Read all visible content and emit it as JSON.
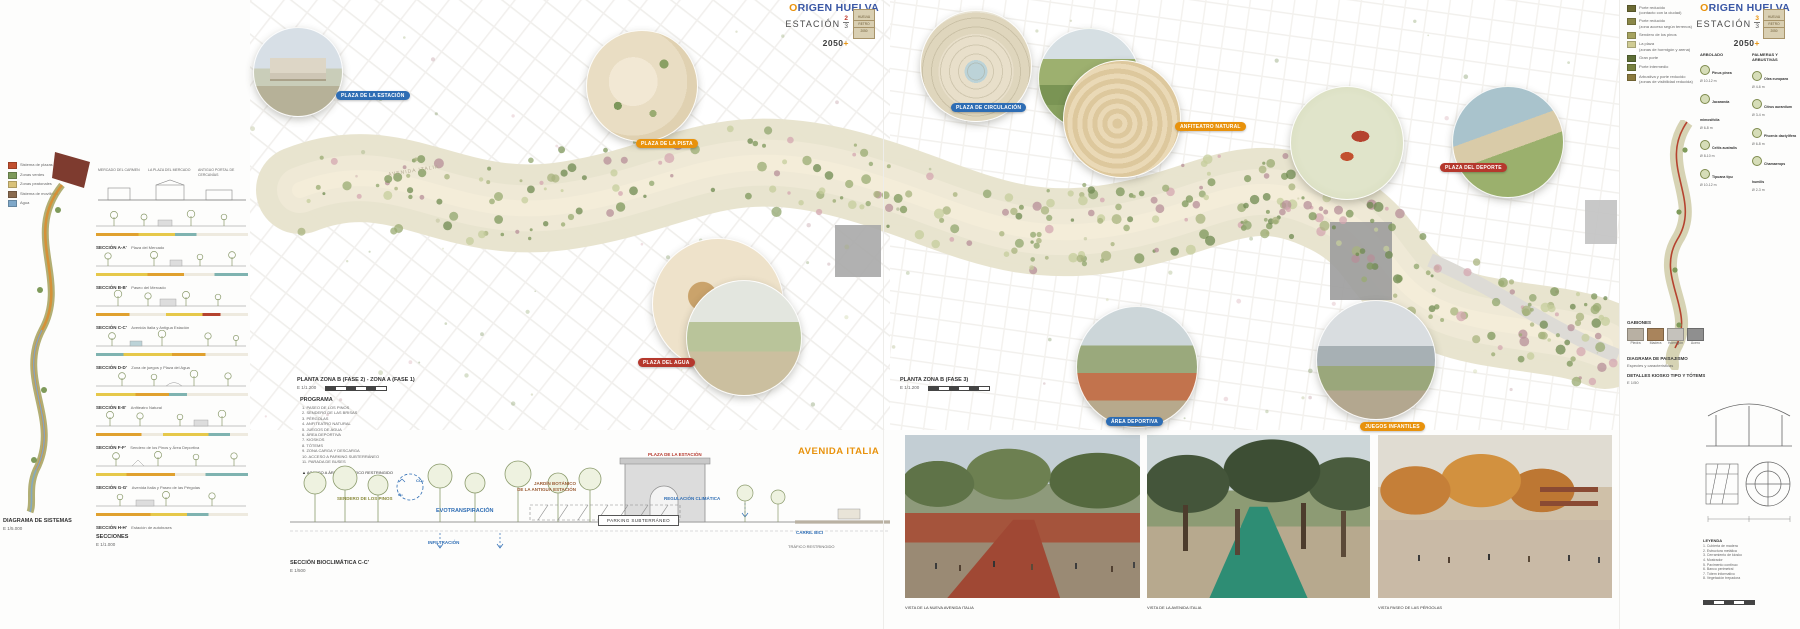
{
  "headers": {
    "left": {
      "brand_o": "O",
      "brand_rest": "RIGEN",
      "brand_b": "HUELVA",
      "station": "ESTACIÓN",
      "sheet_num": "2",
      "sheet_total": "3",
      "year": "2050",
      "year_plus": "+",
      "stamp_lines": [
        "HUELVA",
        "RETRO",
        "2050"
      ]
    },
    "right": {
      "brand_o": "O",
      "brand_rest": "RIGEN",
      "brand_b": "HUELVA",
      "station": "ESTACIÓN",
      "sheet_num": "3",
      "sheet_total": "3",
      "year": "2050",
      "year_plus": "+",
      "stamp_lines": [
        "HUELVA",
        "RETRO",
        "2050"
      ]
    }
  },
  "colors": {
    "badge_blue": "#2e6db4",
    "badge_orange": "#e8920c",
    "badge_red": "#b5382d",
    "brand_blue": "#3a57a5",
    "accent_orange": "#e8920c"
  },
  "plan": {
    "street_label": "AVENIDA ITALIA",
    "badges": [
      {
        "label": "PLAZA DE LA ESTACIÓN",
        "color": "blue"
      },
      {
        "label": "PLAZA DE LA PISTA",
        "color": "orange"
      },
      {
        "label": "PLAZA DE CIRCULACIÓN",
        "color": "blue"
      },
      {
        "label": "ANFITEATRO NATURAL",
        "color": "orange"
      },
      {
        "label": "PLAZA DEL DEPORTE",
        "color": "red"
      },
      {
        "label": "PLAZA DEL AGUA",
        "color": "red"
      },
      {
        "label": "ÁREA DEPORTIVA",
        "color": "blue"
      },
      {
        "label": "JUEGOS INFANTILES",
        "color": "orange"
      }
    ]
  },
  "systems": {
    "legend": [
      {
        "label": "Sistema de plazas",
        "color": "#c2502f"
      },
      {
        "label": "Zonas verdes",
        "color": "#7e9a5a"
      },
      {
        "label": "Zonas peatonales",
        "color": "#d9c27a"
      },
      {
        "label": "Sistema de movilidad",
        "color": "#8a6b4f"
      },
      {
        "label": "Agua",
        "color": "#7fa8c9"
      }
    ],
    "caption": "DIAGRAMA DE SISTEMAS",
    "scale": "E 1/5.000"
  },
  "sections": {
    "top_labels": [
      "MERCADO DEL CARMEN",
      "LA PLAZA DEL MERCADO",
      "ANTIGUO PORTAL DE CERCANÍAS"
    ],
    "items": [
      {
        "id": "SECCIÓN A-A'",
        "caption": "Plaza del Mercado"
      },
      {
        "id": "SECCIÓN B-B'",
        "caption": "Paseo del Mercado"
      },
      {
        "id": "SECCIÓN C-C'",
        "caption": "Avenida Italia y Antigua Estación"
      },
      {
        "id": "SECCIÓN D-D'",
        "caption": "Zona de juegos y Plaza del Agua"
      },
      {
        "id": "SECCIÓN E-E'",
        "caption": "Anfiteatro Natural"
      },
      {
        "id": "SECCIÓN F-F'",
        "caption": "Sendero de los Pinos y Área Deportiva"
      },
      {
        "id": "SECCIÓN G-G'",
        "caption": "Avenida Italia y Paseo de las Pérgolas"
      },
      {
        "id": "SECCIÓN H-H'",
        "caption": "Estación de autobuses"
      }
    ],
    "footer": "SECCIONES",
    "footer_scale": "E 1/1.000"
  },
  "bottom_left": {
    "plan_title": "PLANTA ZONA B (FASE 2) - ZONA A (FASE 1)",
    "plan_scale": "E 1/1.200",
    "programa_title": "PROGRAMA",
    "programa": [
      "1. PASEO DE LOS PINOS",
      "2. SENDERO DE LAS BRISAS",
      "3. PÉRGOLAS",
      "4. ANFITEATRO NATURAL",
      "5. JUEGOS DE AGUA",
      "6. ÁREA DEPORTIVA",
      "7. KIOSKOS",
      "8. TÓTEMS",
      "9. ZONA CARGA Y DESCARGA",
      "10. ACCESO A PARKING SUBTERRÁNEO",
      "11. PARADA DE BUSES"
    ],
    "nota": "▲  ACCESO A ÁREA DE TRÁFICO RESTRINGIDO",
    "labels": {
      "sendero": "SENDERO DE LOS PINOS",
      "evo": "EVOTRANSPIRACIÓN",
      "jardin_1": "JARDÍN BOTÁNICO",
      "jardin_2": "DE LA ANTIGUA ESTACIÓN",
      "plaza": "PLAZA DE LA ESTACIÓN",
      "avenida": "AVENIDA ITALIA",
      "regulacion": "REGULACIÓN CLIMÁTICA",
      "infiltracion": "INFILTRACIÓN",
      "parking": "PARKING SUBTERRÁNEO",
      "carril": "CARRIL BICI",
      "trafico": "TRÁFICO RESTRINGIDO",
      "co2": "CO₂",
      "o2": "O₂"
    },
    "section_title": "SECCIÓN BIOCLIMÁTICA C-C'",
    "section_scale": "E 1/500",
    "plan2_title": "PLANTA ZONA B (FASE 3)",
    "plan2_scale": "E 1/1.200"
  },
  "renders": [
    {
      "caption": "VISTA DE LA NUEVA AVENIDA ITALIA"
    },
    {
      "caption": "VISTA DE LA AVENIDA ITALIA"
    },
    {
      "caption": "VISTA PASEO DE LAS PÉRGOLAS"
    }
  ],
  "right_panel": {
    "legend": [
      {
        "label": "Porte reducido",
        "sub": "(contacto con la ciudad)",
        "color": "#6b6a33"
      },
      {
        "label": "Porte reducido",
        "sub": "(zona acceso según terrenos)",
        "color": "#8a8748"
      },
      {
        "label": "Sendero de los pinos",
        "sub": "",
        "color": "#a6a35f"
      },
      {
        "label": "La plaza",
        "sub": "(zonas de hormigón y arena)",
        "color": "#cfcb93"
      },
      {
        "label": "Gran porte",
        "sub": "",
        "color": "#5d6e35"
      },
      {
        "label": "Porte intermedio",
        "sub": "",
        "color": "#77813f"
      },
      {
        "label": "Arbustiva y porte reducido",
        "sub": "(zonas de visibilidad reducida)",
        "color": "#8b7a3e"
      }
    ],
    "palette_header_1": "ARBOLADO",
    "palette_header_2": "PALMERAS Y ARBUSTIVAS",
    "palette": [
      {
        "name": "Pinus pinea",
        "spec": "Ø 10-12 m"
      },
      {
        "name": "Jacaranda mimosifolia",
        "spec": "Ø 6-8 m"
      },
      {
        "name": "Celtis australis",
        "spec": "Ø 8-10 m"
      },
      {
        "name": "Tipuana tipu",
        "spec": "Ø 10-12 m"
      },
      {
        "name": "Olea europaea",
        "spec": "Ø 4-6 m"
      },
      {
        "name": "Citrus aurantium",
        "spec": "Ø 3-4 m"
      },
      {
        "name": "Phoenix dactylifera",
        "spec": "Ø 6-8 m"
      },
      {
        "name": "Chamaerops humilis",
        "spec": "Ø 2-3 m"
      }
    ],
    "materials_title": "GABIONES",
    "materials": [
      "Piedra",
      "Madera",
      "Hormigón",
      "Acero"
    ],
    "caption1": "DIAGRAMA DE PAISAJISMO",
    "caption1_sub": "Especies y características",
    "caption2": "DETALLES KIOSKO TIPO Y TÓTEMS",
    "caption2_sub": "E 1/50",
    "leyenda_title": "LEYENDA",
    "leyenda": [
      "1. Cubierta de madera",
      "2. Estructura metálica",
      "3. Cerramiento de kiosko",
      "4. Mostrador",
      "5. Pavimento continuo",
      "6. Banco perimetral",
      "7. Tótem informativo",
      "8. Vegetación trepadora"
    ]
  }
}
